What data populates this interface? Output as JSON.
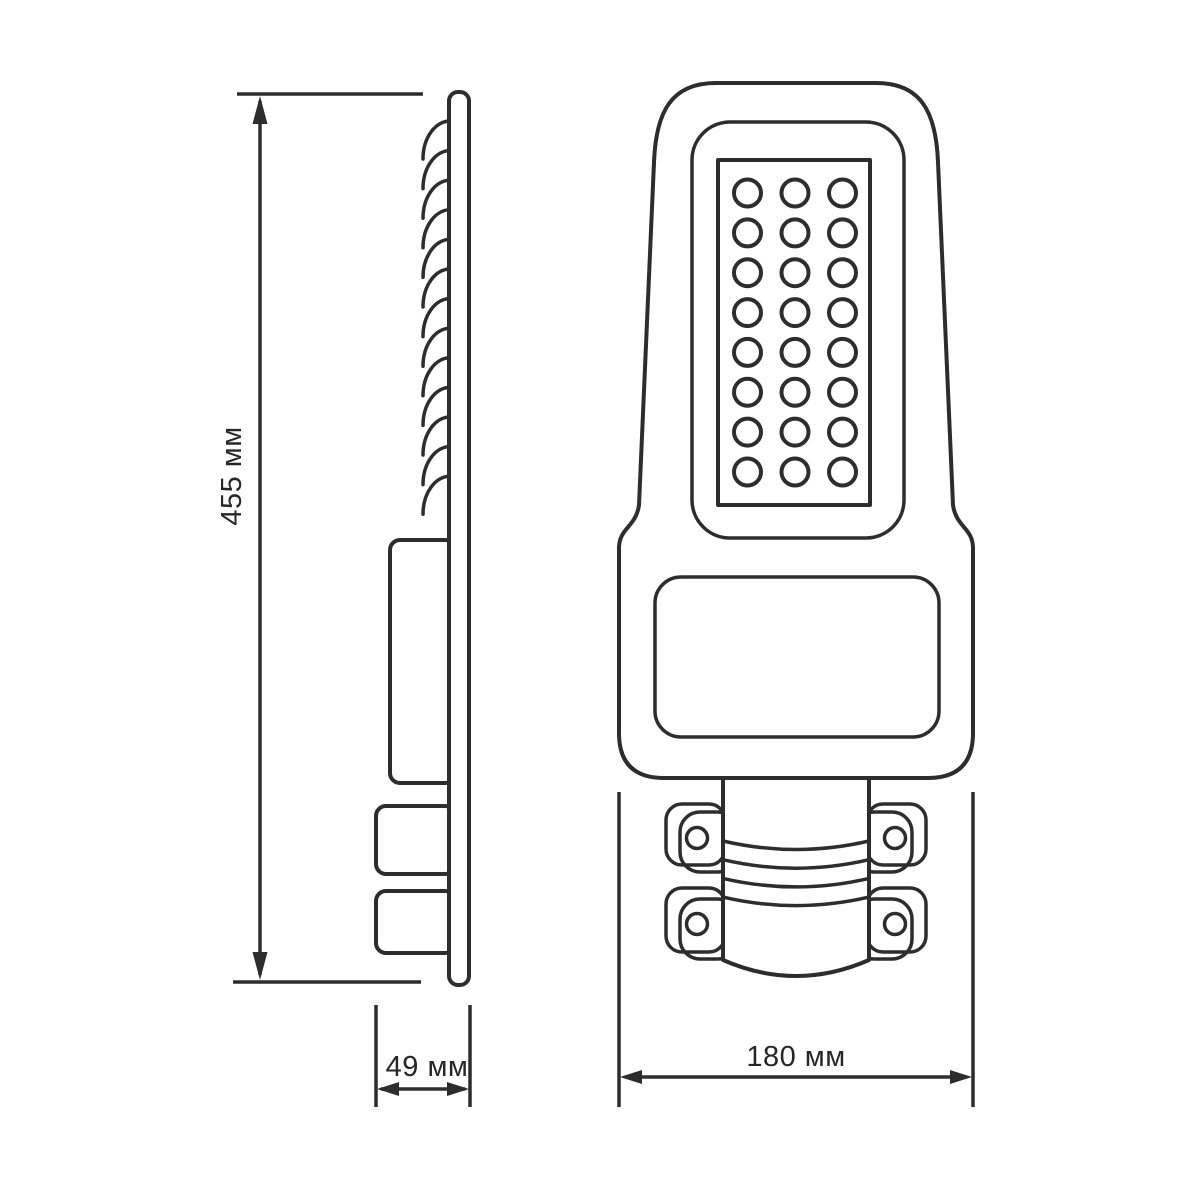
{
  "title": "LED street light dimensional drawing",
  "canvas": {
    "background": "#ffffff",
    "line_color": "#2d2d2d",
    "text_color": "#262626"
  },
  "dimensions": {
    "height": {
      "label": "455 мм",
      "orientation": "vertical"
    },
    "depth": {
      "label": "49 мм",
      "orientation": "horizontal"
    },
    "width": {
      "label": "180 мм",
      "orientation": "horizontal"
    }
  },
  "views": {
    "side": {
      "name": "side-view",
      "heatsink_fins": 13,
      "mount_blocks": 2
    },
    "front": {
      "name": "front-view",
      "led_columns": 3,
      "led_rows": 8,
      "led_count": 24,
      "clamp_ears": 4,
      "bolt_holes": 4,
      "strap_lines": 4
    }
  }
}
